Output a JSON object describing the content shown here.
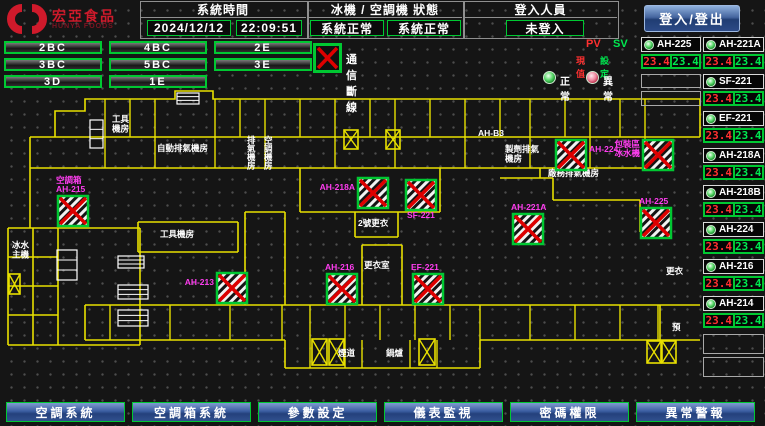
{
  "header": {
    "brand": "宏亞食品",
    "brand_en": "HUNYA FOODS",
    "system_time_label": "系統時間",
    "date": "2024/12/12",
    "time": "22:09:51",
    "status_label": "冰機 / 空調機 狀態",
    "chiller_status": "系統正常",
    "ahu_status": "系統正常",
    "login_label": "登入人員",
    "login_status": "未登入",
    "login_button": "登入/登出"
  },
  "floor_buttons": [
    "2BC",
    "4BC",
    "2E",
    "3BC",
    "5BC",
    "3E",
    "3D",
    "1E"
  ],
  "legend": {
    "comm_loss": "通信斷線",
    "pv_label": "PV",
    "sv_label": "SV",
    "pv_sub": "現值",
    "sv_sub": "設定",
    "normal": "正常",
    "abnormal": "異常"
  },
  "panel": {
    "left_col_x": 641,
    "right_col_x": 703,
    "col_w_left": 60,
    "col_w_right": 61,
    "row0_y": 37,
    "pitch": 37,
    "name_h": 15,
    "val_h": 15,
    "val_dy": 17,
    "left_units": [
      {
        "name": "AH-225",
        "pv": "23.4",
        "sv": "23.4"
      }
    ],
    "left_empty": [
      {
        "y": 74,
        "h": 14
      },
      {
        "y": 91,
        "h": 15
      }
    ],
    "right_units": [
      {
        "name": "AH-221A",
        "pv": "23.4",
        "sv": "23.4"
      },
      {
        "name": "SF-221",
        "pv": "23.4",
        "sv": "23.4"
      },
      {
        "name": "EF-221",
        "pv": "23.4",
        "sv": "23.4"
      },
      {
        "name": "AH-218A",
        "pv": "23.4",
        "sv": "23.4"
      },
      {
        "name": "AH-218B",
        "pv": "23.4",
        "sv": "23.4"
      },
      {
        "name": "AH-224",
        "pv": "23.4",
        "sv": "23.4"
      },
      {
        "name": "AH-216",
        "pv": "23.4",
        "sv": "23.4"
      },
      {
        "name": "AH-214",
        "pv": "23.4",
        "sv": "23.4"
      }
    ],
    "right_empty": [
      {
        "y": 334,
        "h": 20
      },
      {
        "y": 357,
        "h": 20
      }
    ]
  },
  "nav_buttons": [
    "空調系統",
    "空調箱系統",
    "參數設定",
    "儀表監視",
    "密碼權限",
    "異常警報"
  ],
  "colors": {
    "wall": "#e8e000",
    "device_border": "#00c832",
    "device_x": "#dd0000",
    "device_label": "#ff3df0",
    "room_label": "#ffffff",
    "accent_green": "#00c832",
    "pv_red": "#ff3030",
    "sv_green": "#00e850",
    "nav_blue": "#3c5ea2",
    "brand_red": "#cf1a2b"
  },
  "plan": {
    "walls": [
      "55,137 55,111 85,111 85,99 175,99 175,91 213,91 213,99 700,99",
      "30,137 700,137",
      "700,99 700,137",
      "30,168 645,168",
      "30,137 30,228",
      "8,228 140,228",
      "8,228 8,345",
      "8,345 140,345",
      "140,228 140,345",
      "33,228 33,345",
      "58,228 58,345",
      "8,257 58,257",
      "8,286 58,286",
      "8,315 58,315",
      "85,305 700,305",
      "85,305 85,340",
      "85,340 285,340",
      "285,340 285,368",
      "285,368 480,368",
      "480,368 480,340",
      "480,340 700,340",
      "138,222 238,222",
      "138,222 138,252",
      "238,222 238,252",
      "138,252 238,252",
      "245,212 245,305",
      "285,212 285,305",
      "245,212 285,212",
      "362,245 362,305",
      "402,245 402,305",
      "362,245 402,245",
      "300,168 300,212",
      "300,212 440,212",
      "440,168 440,212",
      "355,212 355,237",
      "398,212 398,237",
      "355,237 398,237",
      "500,178 553,178",
      "553,178 553,200",
      "553,200 640,200",
      "640,200 640,232",
      "540,168 540,178",
      "660,305 660,340"
    ],
    "xs_top": {
      "y1": 99,
      "y2": 137,
      "xs": [
        105,
        130,
        155,
        215,
        240,
        265,
        300,
        335,
        370,
        395,
        430,
        465,
        500,
        530,
        565,
        590,
        620,
        645
      ]
    },
    "xs_mid": {
      "y1": 137,
      "y2": 168,
      "xs": [
        105,
        155,
        215,
        265,
        335,
        395,
        465,
        530,
        590,
        645
      ]
    },
    "xs_bottom": {
      "y1": 305,
      "y2": 340,
      "xs": [
        110,
        170,
        230,
        282,
        310,
        345,
        380,
        415,
        450,
        480,
        530,
        575,
        620,
        658
      ]
    },
    "xs_boiler": {
      "y1": 340,
      "y2": 368,
      "xs": [
        310,
        345,
        362,
        410,
        437
      ]
    },
    "devices": [
      {
        "label": "空調箱\nAH-215",
        "pos": "above",
        "x": 58,
        "y": 196
      },
      {
        "label": "AH-218A",
        "pos": "left",
        "x": 358,
        "y": 178
      },
      {
        "label": "SF-221",
        "pos": "below",
        "x": 406,
        "y": 180
      },
      {
        "label": "AH-224",
        "pos": "right",
        "x": 556,
        "y": 140
      },
      {
        "label": "包裝區\n冰水機",
        "pos": "left",
        "x": 643,
        "y": 140
      },
      {
        "label": "AH-221A",
        "pos": "above",
        "x": 513,
        "y": 214
      },
      {
        "label": "AH-213",
        "pos": "left",
        "x": 217,
        "y": 273
      },
      {
        "label": "AH-216",
        "pos": "above",
        "x": 327,
        "y": 274
      },
      {
        "label": "EF-221",
        "pos": "above",
        "x": 413,
        "y": 274
      },
      {
        "label": "AH-225",
        "pos": "above",
        "x": 641,
        "y": 208
      }
    ],
    "device_w": 30,
    "device_h": 30,
    "room_labels": [
      {
        "text": "工具\n機房",
        "x": 112,
        "y": 122
      },
      {
        "text": "自動排氣機房",
        "x": 157,
        "y": 151
      },
      {
        "text": "排氣機房",
        "x": 247,
        "y": 143,
        "vertical": true
      },
      {
        "text": "空調機房",
        "x": 264,
        "y": 143,
        "vertical": true
      },
      {
        "text": "AH-B3",
        "x": 478,
        "y": 136
      },
      {
        "text": "製劑排氣\n機房",
        "x": 505,
        "y": 152
      },
      {
        "text": "廠務排氣機房",
        "x": 548,
        "y": 176
      },
      {
        "text": "2號更衣",
        "x": 358,
        "y": 226
      },
      {
        "text": "工具機房",
        "x": 160,
        "y": 237
      },
      {
        "text": "更衣室",
        "x": 364,
        "y": 268
      },
      {
        "text": "冰水\n主機",
        "x": 12,
        "y": 248
      },
      {
        "text": "煙道",
        "x": 338,
        "y": 356
      },
      {
        "text": "鍋爐",
        "x": 386,
        "y": 356
      },
      {
        "text": "更衣",
        "x": 666,
        "y": 274
      },
      {
        "text": "預",
        "x": 672,
        "y": 330
      }
    ],
    "fans": [
      {
        "x": 344,
        "y": 130,
        "w": 14,
        "h": 19
      },
      {
        "x": 386,
        "y": 130,
        "w": 14,
        "h": 19
      },
      {
        "x": 312,
        "y": 339,
        "w": 15,
        "h": 26
      },
      {
        "x": 329,
        "y": 339,
        "w": 15,
        "h": 26
      },
      {
        "x": 419,
        "y": 339,
        "w": 16,
        "h": 26
      },
      {
        "x": 647,
        "y": 341,
        "w": 14,
        "h": 22
      },
      {
        "x": 662,
        "y": 341,
        "w": 14,
        "h": 22
      },
      {
        "x": 9,
        "y": 274,
        "w": 11,
        "h": 20
      }
    ],
    "equipment": [
      {
        "x": 90,
        "y": 120,
        "w": 13,
        "h": 28
      },
      {
        "x": 57,
        "y": 250,
        "w": 20,
        "h": 30
      },
      {
        "x": 118,
        "y": 256,
        "w": 26,
        "h": 12
      },
      {
        "x": 118,
        "y": 285,
        "w": 30,
        "h": 14
      },
      {
        "x": 118,
        "y": 310,
        "w": 30,
        "h": 16
      },
      {
        "x": 177,
        "y": 93,
        "w": 22,
        "h": 11
      }
    ]
  }
}
